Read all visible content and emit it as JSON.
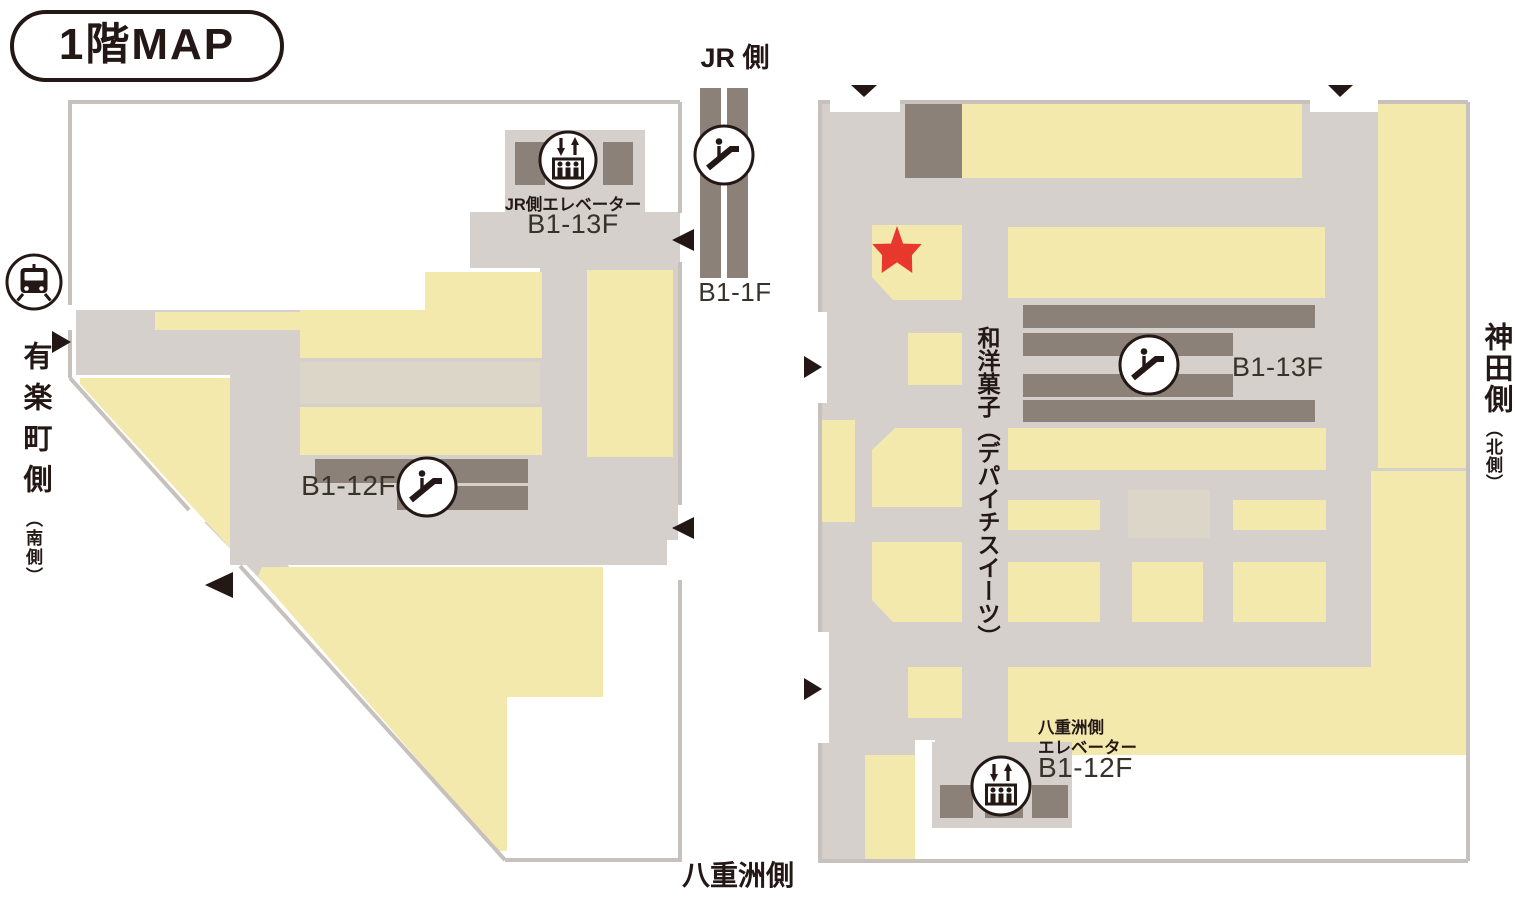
{
  "title": "1階MAP",
  "palette": {
    "shop_yellow": "#f3e9ad",
    "shop_beige": "#dcd6c8",
    "walkway_gray": "#d5d0cb",
    "border_gray": "#c6c1bc",
    "block_dark": "#8b8178",
    "ink": "#231815",
    "star_red": "#e8382d"
  },
  "labels": {
    "jr_side": "JR 側",
    "jr_channel_range": "B1-1F",
    "yurakucho_side": "有楽町側",
    "yurakucho_note": "（南側）",
    "kanda_side": "神田側",
    "kanda_note": "（北側）",
    "yaesu_side_bottom": "八重洲側",
    "sweets_vertical": "和洋菓子（デパイチスイーツ）"
  },
  "left_building": {
    "jr_elevator_label": "JR側エレベーター",
    "jr_elevator_range": "B1-13F",
    "escalator_range": "B1-12F"
  },
  "right_building": {
    "escalator_range": "B1-13F",
    "yaesu_elevator_label_line1": "八重洲側",
    "yaesu_elevator_label_line2": "エレベーター",
    "yaesu_elevator_range": "B1-12F"
  },
  "icons": {
    "train": "train-icon (station side marker)",
    "escalator": "escalator-icon",
    "elevator": "elevator-icon",
    "entrance_arrow": "black triangle entrance arrow",
    "current_location": "red star marker"
  }
}
